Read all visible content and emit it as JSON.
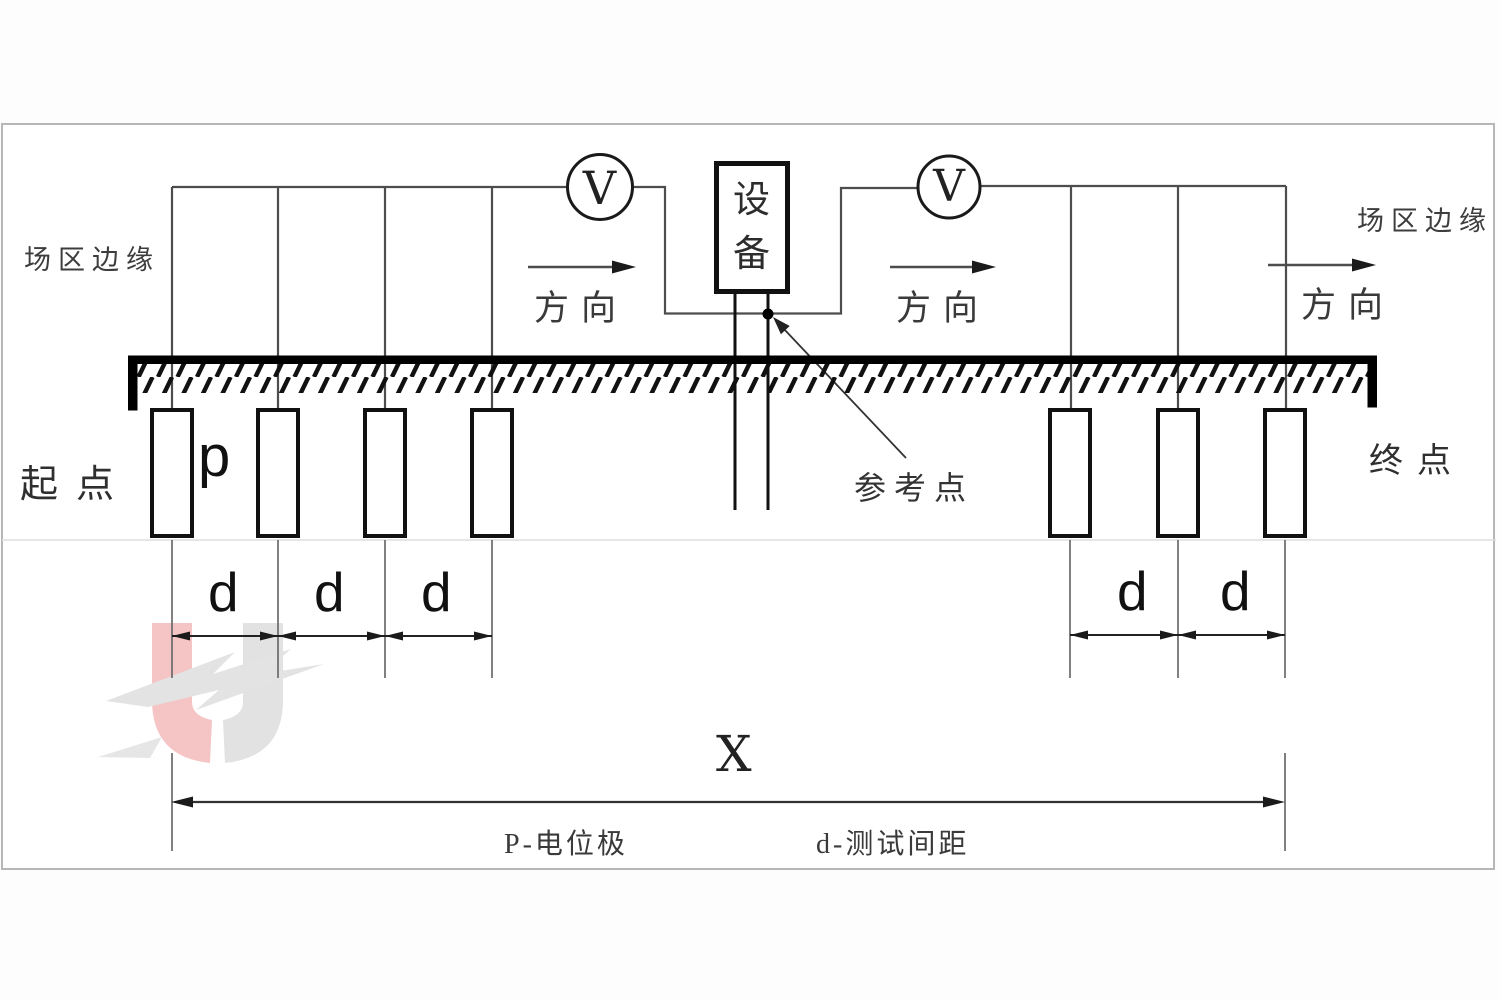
{
  "diagram": {
    "description": "ground potential electrode test layout",
    "labels": {
      "field_edge": "场区边缘",
      "direction": "方向",
      "voltmeter": "V",
      "equipment": "设备",
      "start_point": "起点",
      "end_point": "终点",
      "potential_electrode": "p",
      "spacing": "d",
      "reference_point": "参考点",
      "total_span": "X",
      "legend_potential": "P-电位极",
      "legend_spacing": "d-测试间距"
    },
    "colors": {
      "line_black": "#111111",
      "wire_gray": "#4d4d4d",
      "text": "#333333",
      "frame_border": "#b6b6b6",
      "watermark_pink": "#f5c4c4",
      "watermark_gray": "#e2e2e2"
    }
  }
}
